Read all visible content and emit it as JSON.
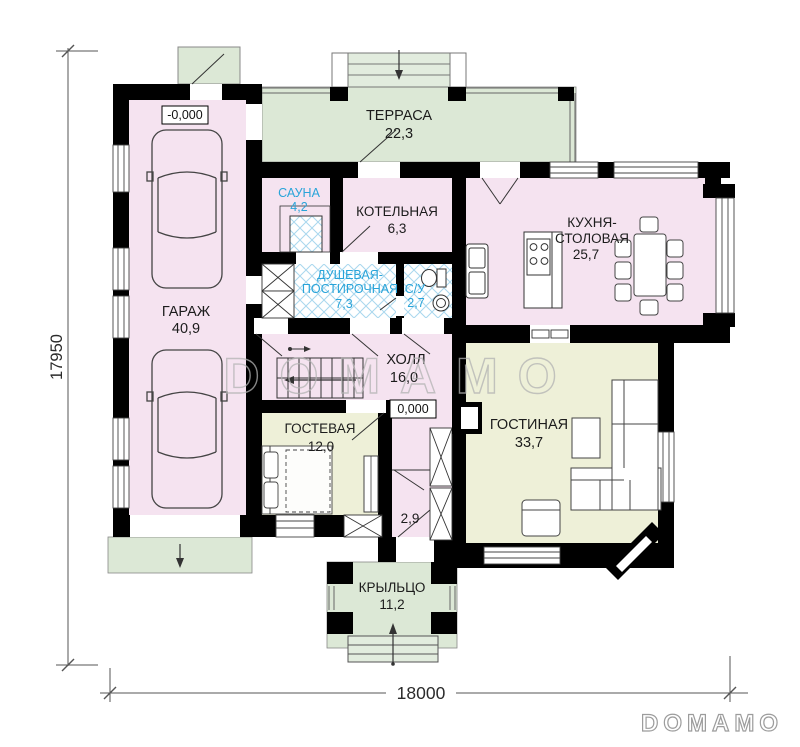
{
  "watermark": "DOMAMO",
  "logo": "DOMAMO",
  "dimensions": {
    "left": "17950",
    "bottom": "18000"
  },
  "elevations": {
    "garage": "-0,000",
    "hall": "0,000"
  },
  "rooms": {
    "terrace": {
      "name": "ТЕРРАСА",
      "area": "22,3"
    },
    "sauna": {
      "name": "САУНА",
      "area": "4,2"
    },
    "boiler": {
      "name": "КОТЕЛЬНАЯ",
      "area": "6,3"
    },
    "kitchen": {
      "name1": "КУХНЯ-",
      "name2": "СТОЛОВАЯ",
      "area": "25,7"
    },
    "shower": {
      "name1": "ДУШЕВАЯ-",
      "name2": "ПОСТИРОЧНАЯ",
      "area": "7,3"
    },
    "wc": {
      "name": "С/У",
      "area": "2,7"
    },
    "garage": {
      "name": "ГАРАЖ",
      "area": "40,9"
    },
    "hall": {
      "name": "ХОЛЛ",
      "area": "16,0"
    },
    "guest": {
      "name": "ГОСТЕВАЯ",
      "area": "12,0"
    },
    "living": {
      "name": "ГОСТИНАЯ",
      "area": "33,7"
    },
    "vestibule": {
      "area": "2,9"
    },
    "porch": {
      "name": "КРЫЛЬЦО",
      "area": "11,2"
    }
  },
  "colors": {
    "wall": "#000000",
    "room_pink": "#f5e3f0",
    "room_yellow": "#eef0d8",
    "outdoor_green": "#dce8d6",
    "tile_blue": "#a9d7ee",
    "wet_label_blue": "#29a4d9",
    "watermark_gray": "#b3b3b3"
  }
}
